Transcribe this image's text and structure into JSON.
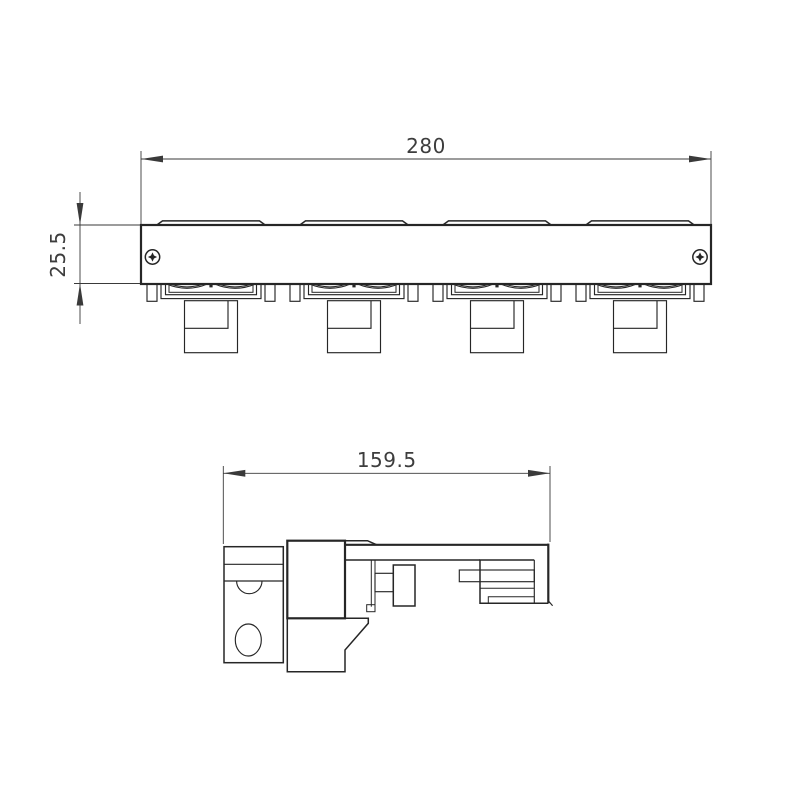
{
  "drawing": {
    "background": "#ffffff",
    "line_color": "#262626",
    "dim_color": "#3a3a3a",
    "front_view": {
      "width_label": "280",
      "height_label": "25.5",
      "module_count": 4,
      "lenses_per_module": 2,
      "screw_count": 2
    },
    "side_view": {
      "width_label": "159.5"
    }
  }
}
